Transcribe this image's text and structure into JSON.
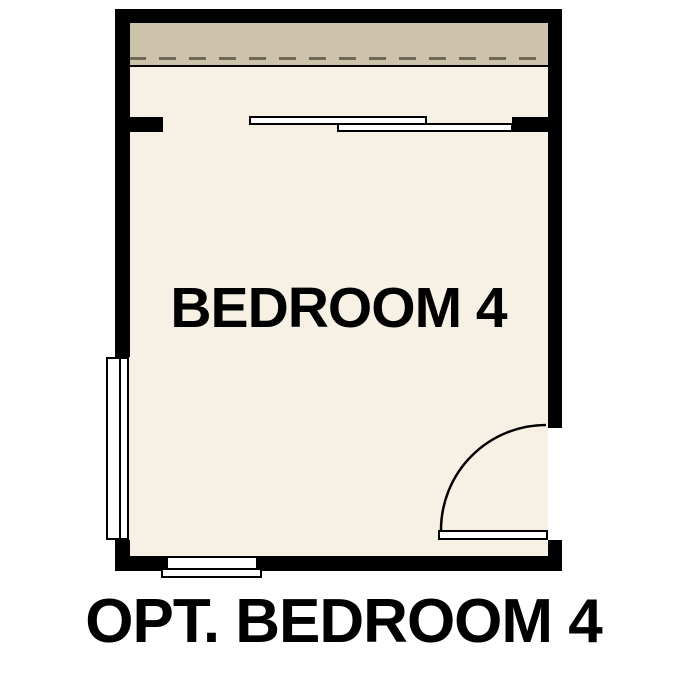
{
  "plan": {
    "room_label": "BEDROOM 4",
    "caption": "OPT. BEDROOM 4"
  },
  "colors": {
    "background": "#ffffff",
    "wall": "#000000",
    "floor": "#f7f0e4",
    "band": "#cdc3aa",
    "dash": "#6f6757",
    "text": "#000000"
  },
  "symbols": {
    "top_opening": "bypass-sliding-panels",
    "left_window": "double-pane-window",
    "bottom_window": "window-with-sill",
    "door": "hinged-door-quarter-swing",
    "overhead": "dashed-overhead-line"
  }
}
